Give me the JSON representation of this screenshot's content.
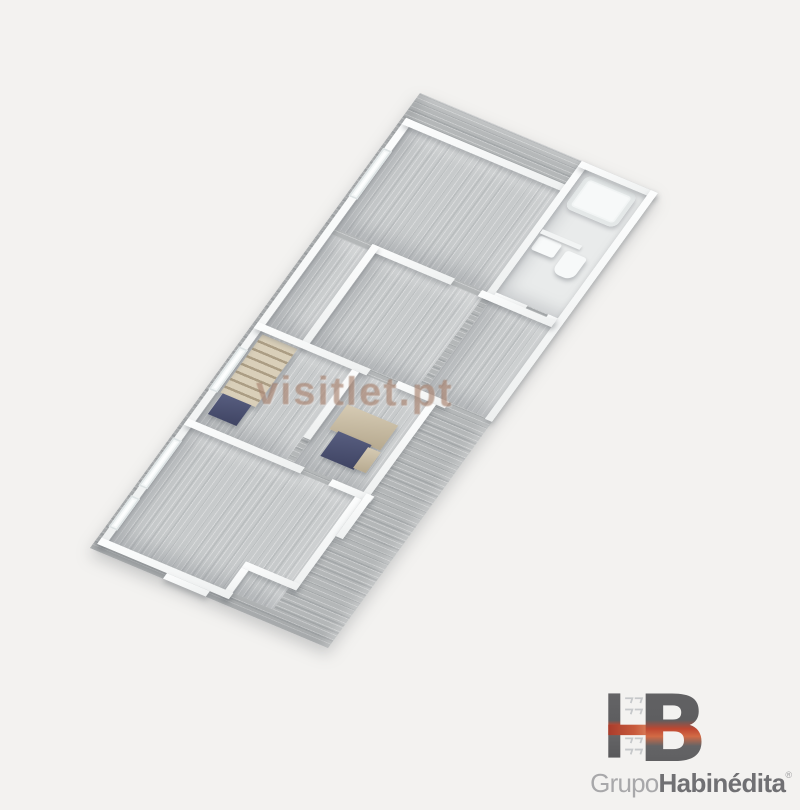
{
  "watermark": {
    "text": "visitlet.pt"
  },
  "logo": {
    "monogram_h": "H",
    "monogram_b": "B",
    "group_word": "Grupo",
    "brand_word": "Habinédita",
    "registered_mark": "®"
  },
  "colors": {
    "background": "#f3f2f0",
    "slab_floor": "#b4b7b8",
    "room_floor": "#c7cacb",
    "bathroom_floor": "#e9ebeb",
    "wall": "#f5f6f6",
    "watermark_text": "#96684f",
    "furniture_navy": "#4d5374",
    "furniture_beige": "#cbbfa8",
    "logo_gray": "#636365",
    "logo_red": "#c0452f",
    "logo_text_light": "#a8a8aa",
    "logo_text_dark": "#707073"
  }
}
